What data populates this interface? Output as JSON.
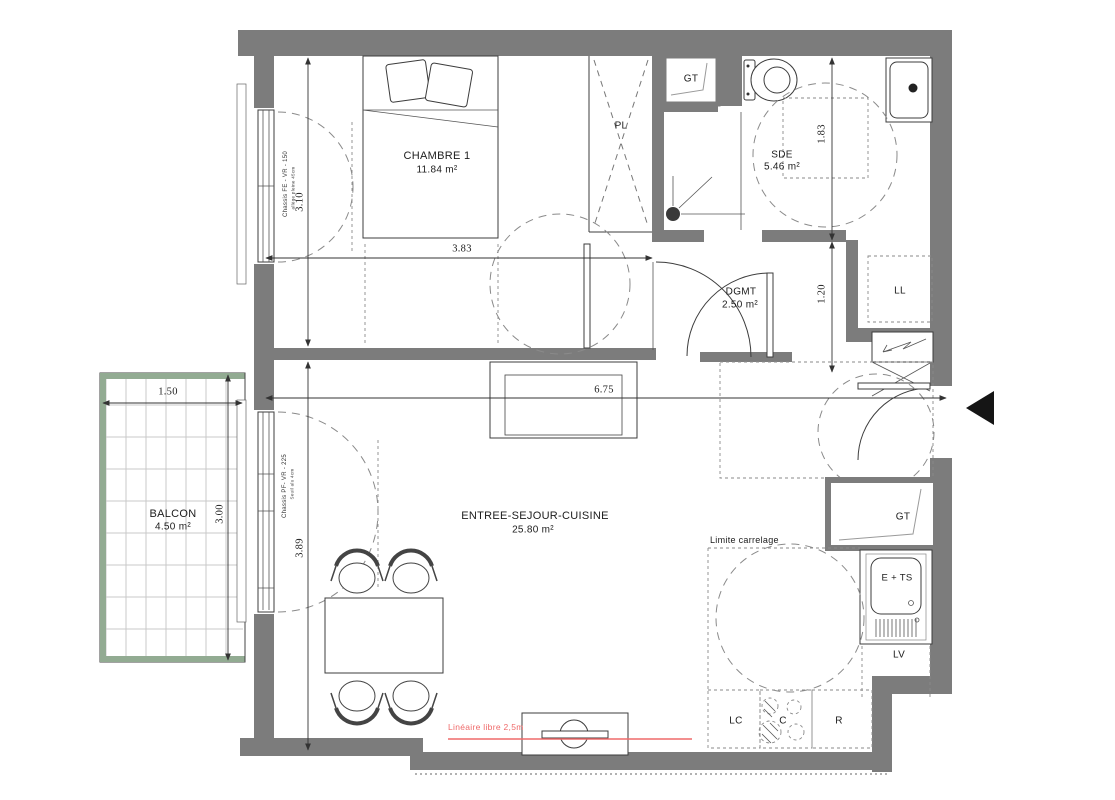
{
  "plan": {
    "colors": {
      "wall": "#7c7c7c",
      "balcony": "#92ab92",
      "red": "#ef6a6a",
      "dash": "#8a8a8a",
      "grid": "#c9c9c9"
    },
    "rooms": [
      {
        "name": "CHAMBRE 1",
        "area": "11.84 m²"
      },
      {
        "name": "SDE",
        "area": "5.46 m²"
      },
      {
        "name": "DGMT",
        "area": "2.50 m²"
      },
      {
        "name": "ENTREE-SEJOUR-CUISINE",
        "area": "25.80 m²"
      },
      {
        "name": "BALCON",
        "area": "4.50 m²"
      }
    ],
    "fixtures": {
      "closet": "PL",
      "duct_top": "GT",
      "duct_kitchen": "GT",
      "washer": "LL",
      "dishwasher": "LV",
      "sink_unit": "E + TS",
      "column_cabinet": "LC",
      "cooktop": "C",
      "fridge": "R"
    },
    "dimensions": {
      "chambre_w": "3.83",
      "chambre_h": "3.10",
      "sejour_w": "6.75",
      "sejour_h": "3.89",
      "sde_h": "1.83",
      "dgmt_h": "1.20",
      "balcon_w": "1.50",
      "balcon_h": "3.00"
    },
    "annotations": {
      "chambre_window": "Chassis FE - VR - 150",
      "chambre_window_sub": "allège pleine 45cm",
      "sejour_window": "Chassis PF- VR - 225",
      "sejour_window_sub": "Seuil alu 4cm",
      "tiling_limit": "Limite carrelage",
      "free_run": "Linéaire libre 2,5m"
    }
  }
}
